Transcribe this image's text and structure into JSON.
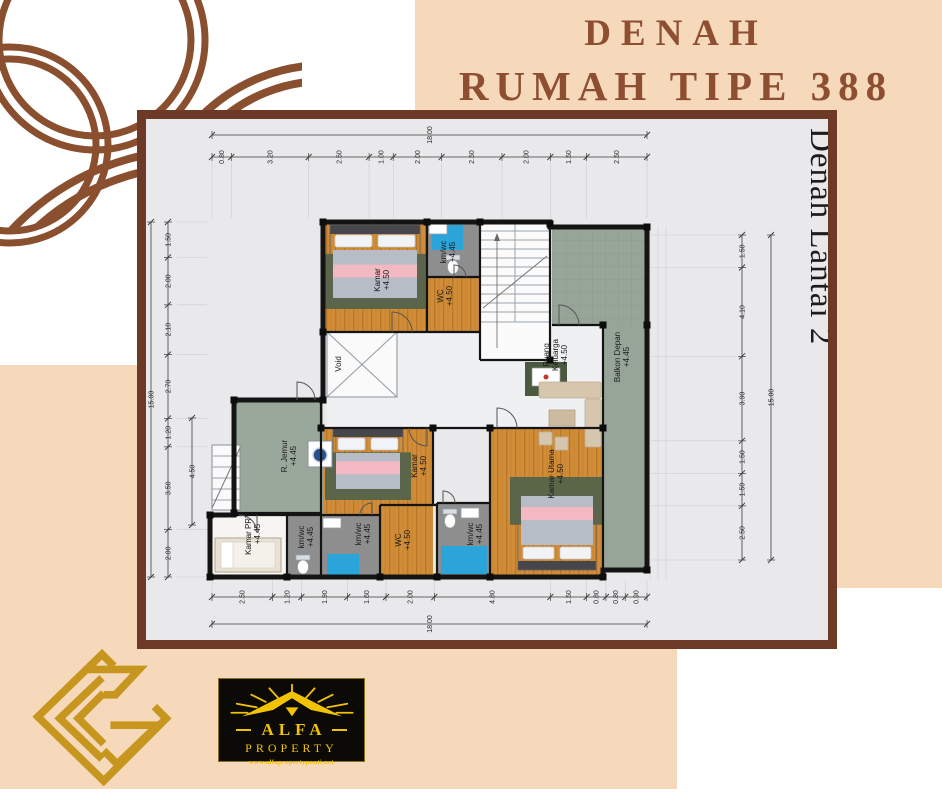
{
  "title": {
    "line1": "DENAH",
    "line2": "RUMAH TIPE 388"
  },
  "floor_label": "Denah Lantai 2",
  "dims": {
    "top_total": "18.00",
    "top": [
      "0.80",
      "3.20",
      "2.50",
      "1.00",
      "2.00",
      "2.50",
      "2.00",
      "1.50",
      "2.50"
    ],
    "bottom_total": "18.00",
    "bottom": [
      "2.50",
      "1.20",
      "1.90",
      "1.60",
      "2.00",
      "4.80",
      "1.50",
      "0.80",
      "0.80",
      "0.90"
    ],
    "left_total": "15.00",
    "left": [
      "1.50",
      "2.00",
      "2.10",
      "2.70",
      "1.20",
      "3.50",
      "2.00"
    ],
    "left_inner": "4.50",
    "right_total": "15.00",
    "right": [
      "1.50",
      "4.10",
      "3.90",
      "1.50",
      "1.50",
      "2.50"
    ]
  },
  "rooms": [
    {
      "name": "Kamar",
      "elev": "+4.50"
    },
    {
      "name": "km/wc",
      "elev": "+4.45"
    },
    {
      "name": "WC",
      "elev": "+4.50"
    },
    {
      "name": "Void",
      "elev": ""
    },
    {
      "name": "Ruang Keluarga",
      "elev": "+4.50"
    },
    {
      "name": "Balkon Depan",
      "elev": "+4.45"
    },
    {
      "name": "R. Jemur",
      "elev": "+4.45"
    },
    {
      "name": "Kamar",
      "elev": "+4.50"
    },
    {
      "name": "WC",
      "elev": "+4.50"
    },
    {
      "name": "Kamar PRT",
      "elev": "+4.45"
    },
    {
      "name": "km/wc",
      "elev": "+4.45"
    },
    {
      "name": "km/wc",
      "elev": "+4.45"
    },
    {
      "name": "km/wc",
      "elev": "+4.45"
    },
    {
      "name": "Kamar Utama",
      "elev": "+4.50"
    }
  ],
  "logo_alfa": {
    "brand": "ALFA",
    "sub": "PROPERTY",
    "url": "www.alfapropertyponti.net"
  },
  "colors": {
    "peach": "#f6d8ba",
    "brown": "#8a4f2e",
    "card_border": "#6d3a27",
    "card_bg": "#e9e9ec",
    "title": "#8d4e31",
    "wood": "#d08c36",
    "balcony_green": "#97a498",
    "wet_blue": "#2ba4d9",
    "gray_floor": "#8e8e8e",
    "gold": "#c6961f",
    "alfa_yellow": "#f2c304"
  }
}
